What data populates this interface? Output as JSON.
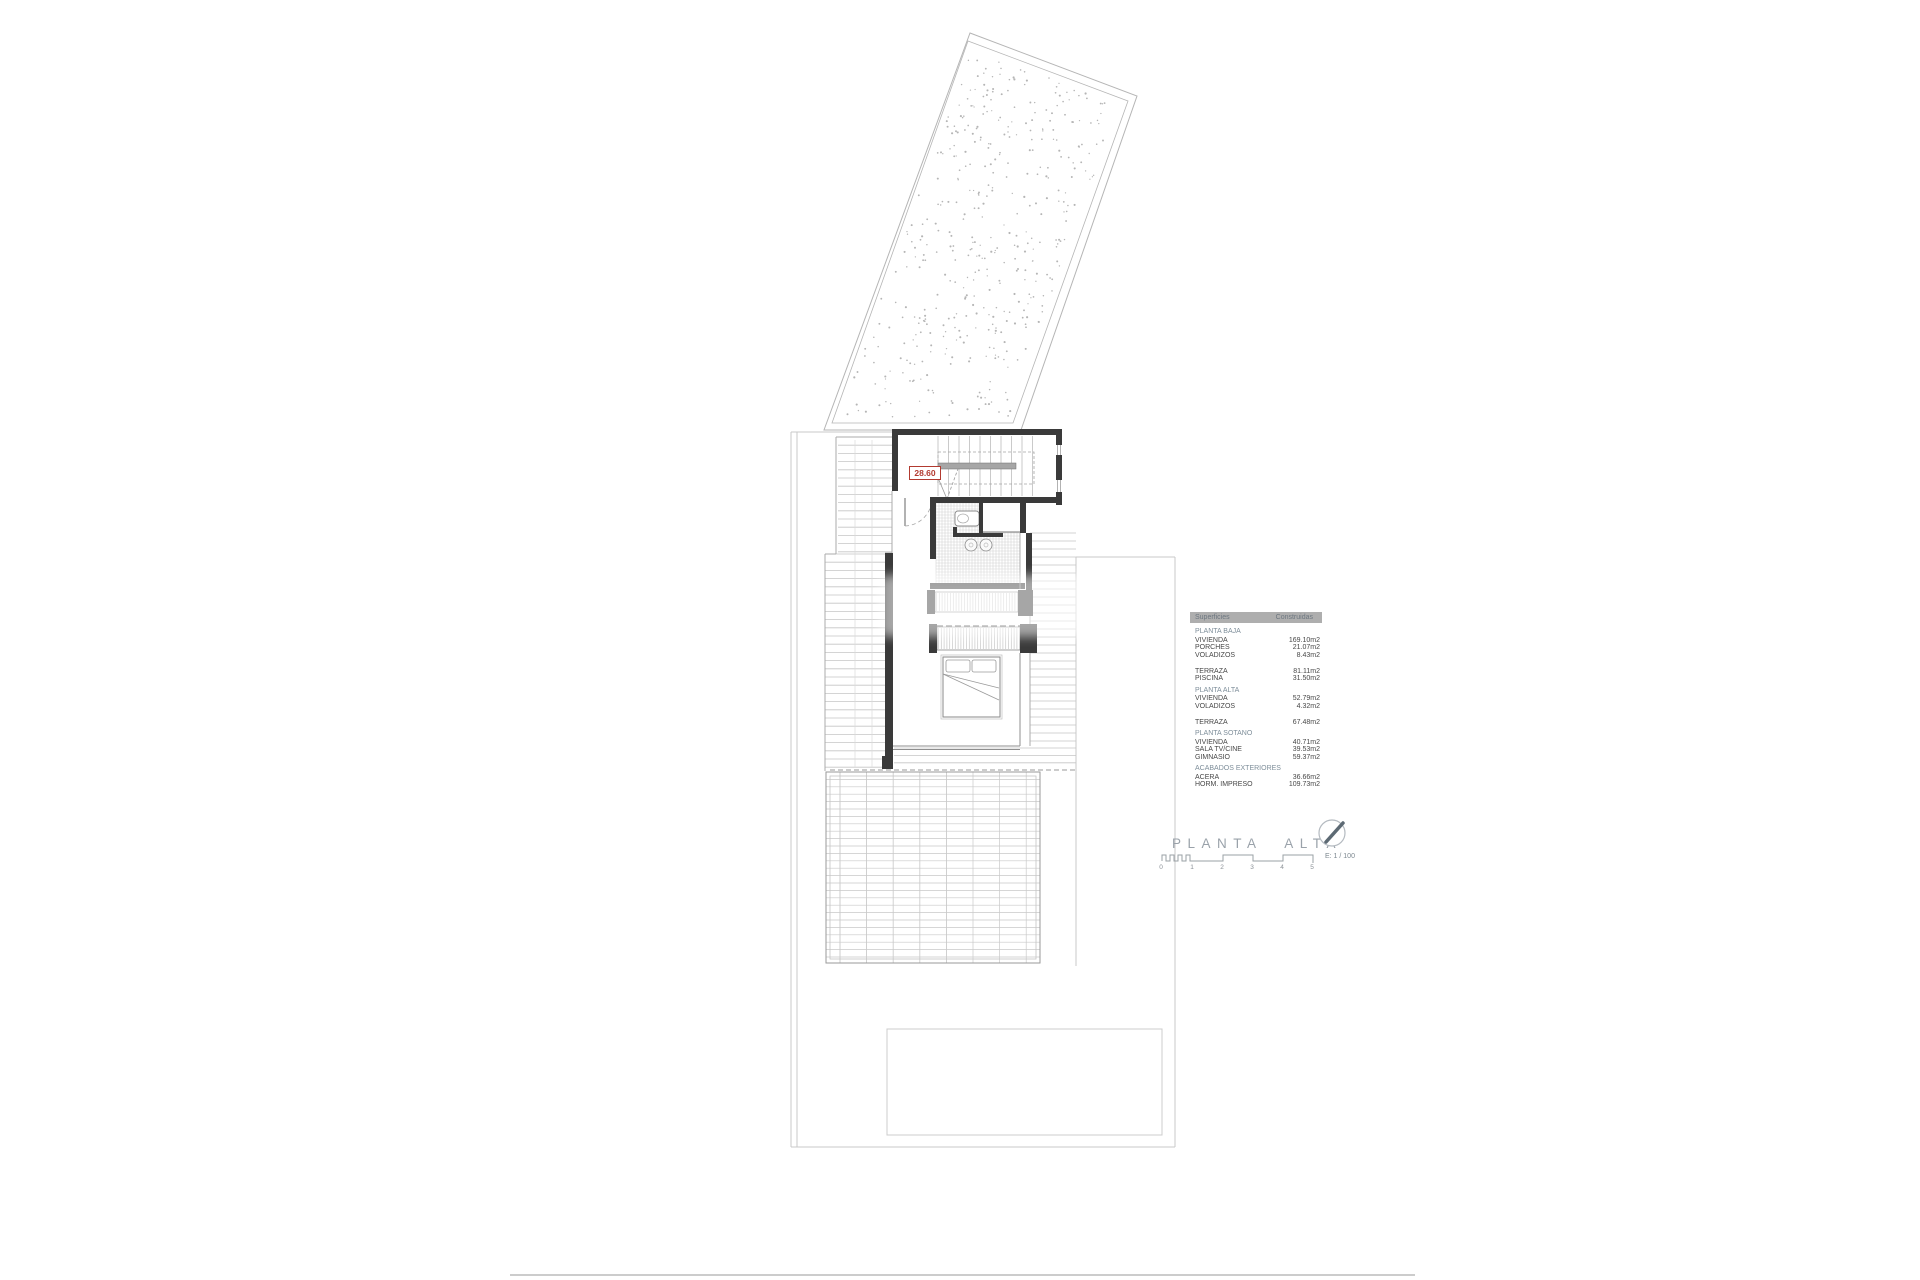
{
  "drawing": {
    "title": "PLANTA ALTA",
    "level_label": "28.60",
    "scale_text": "E: 1 / 100",
    "scale_ticks": [
      "0",
      "1",
      "2",
      "3",
      "4",
      "5"
    ]
  },
  "areas_table": {
    "header": [
      "Superficies",
      "Construidas"
    ],
    "groups": [
      {
        "title": "PLANTA BAJA",
        "rows": [
          [
            "VIVIENDA",
            "169.10m2"
          ],
          [
            "PORCHES",
            "21.07m2"
          ],
          [
            "VOLADIZOS",
            "8.43m2"
          ]
        ]
      },
      {
        "title": "",
        "rows": [
          [
            "TERRAZA",
            "81.11m2"
          ],
          [
            "PISCINA",
            "31.50m2"
          ]
        ]
      },
      {
        "title": "PLANTA ALTA",
        "rows": [
          [
            "VIVIENDA",
            "52.79m2"
          ],
          [
            "VOLADIZOS",
            "4.32m2"
          ]
        ]
      },
      {
        "title": "",
        "rows": [
          [
            "TERRAZA",
            "67.48m2"
          ]
        ]
      },
      {
        "title": "PLANTA SOTANO",
        "rows": [
          [
            "VIVIENDA",
            "40.71m2"
          ],
          [
            "SALA TV/CINE",
            "39.53m2"
          ],
          [
            "GIMNASIO",
            "59.37m2"
          ]
        ]
      },
      {
        "title": "ACABADOS EXTERIORES",
        "rows": [
          [
            "ACERA",
            "36.66m2"
          ],
          [
            "HORM. IMPRESO",
            "109.73m2"
          ]
        ]
      }
    ]
  },
  "colors": {
    "accent_red": "#b23a30",
    "wall_dark": "#3a3a3a",
    "table_header_bg": "#aeaeae",
    "table_header_text": "#6d7780",
    "table_section_text": "#7e8e9a",
    "table_text": "#474747",
    "title_text": "#9aa2aa"
  }
}
